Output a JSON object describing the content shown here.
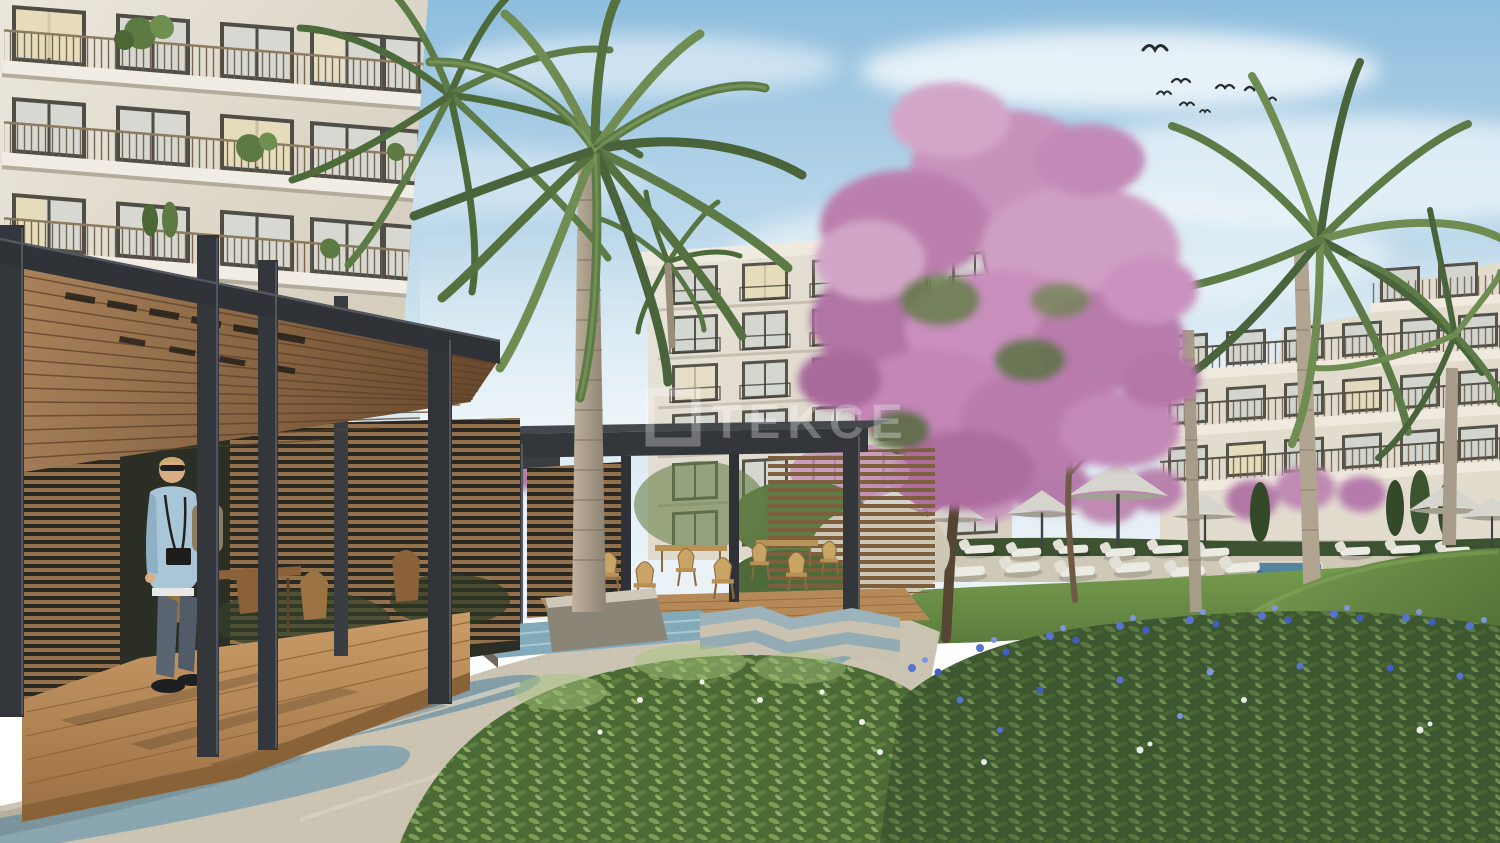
{
  "meta": {
    "type": "architectural-rendering",
    "description": "Courtyard of a modern residential complex with two pergolas, palm trees, a pink flowering tree, landscaped gardens, sun umbrellas and loungers"
  },
  "watermark": {
    "text": "TEKCE",
    "color": "#ffffff"
  },
  "palette": {
    "sky_top": "#8fbede",
    "sky_horizon": "#eaf2f7",
    "facade_light": "#ece7dc",
    "facade_shade": "#cfc8b9",
    "window_frame": "#4f4d45",
    "window_glass": "#d6d8d1",
    "window_lit": "#e9ddb6",
    "pergola_frame": "#33363a",
    "ceiling_wood": "#9a7448",
    "deck_wood": "#bd9260",
    "slat_wood": "#7d5f3e",
    "palm_green": "#5d7b46",
    "palm_trunk": "#ab9f8c",
    "flower_pink": "#c48bb8",
    "flower_blue": "#5673cd",
    "lawn_green": "#6b8f45",
    "hill_green": "#4e6d33",
    "bush_green": "#3d5730",
    "paving_beige": "#cbc4b2",
    "paving_blue": "#8aa6b0",
    "umbrella_gray": "#d6d5cd",
    "lounger_white": "#ecebe3",
    "water_blue": "#82aab8",
    "sweater_blue": "#a9c6d8",
    "jeans_blue": "#5b6572"
  },
  "scene": {
    "sky": {
      "label": "morning sky with soft clouds",
      "birds": 8
    },
    "buildings": [
      {
        "label": "left apartment block with balconies"
      },
      {
        "label": "center apartment block"
      },
      {
        "label": "right terraced apartment block"
      }
    ],
    "structures": [
      {
        "label": "wood-slat lounge pergola"
      },
      {
        "label": "garden dining pergola"
      }
    ],
    "people": [
      {
        "label": "man holding a child"
      }
    ],
    "vegetation": [
      {
        "label": "tall palm trees"
      },
      {
        "label": "pink flowering tree"
      },
      {
        "label": "blue flower shrubs"
      },
      {
        "label": "lawn and grassy hill"
      }
    ],
    "amenities": [
      {
        "label": "sun umbrellas"
      },
      {
        "label": "sun loungers"
      },
      {
        "label": "swimming pool"
      },
      {
        "label": "water feature"
      },
      {
        "label": "wavy paved promenade"
      }
    ]
  }
}
